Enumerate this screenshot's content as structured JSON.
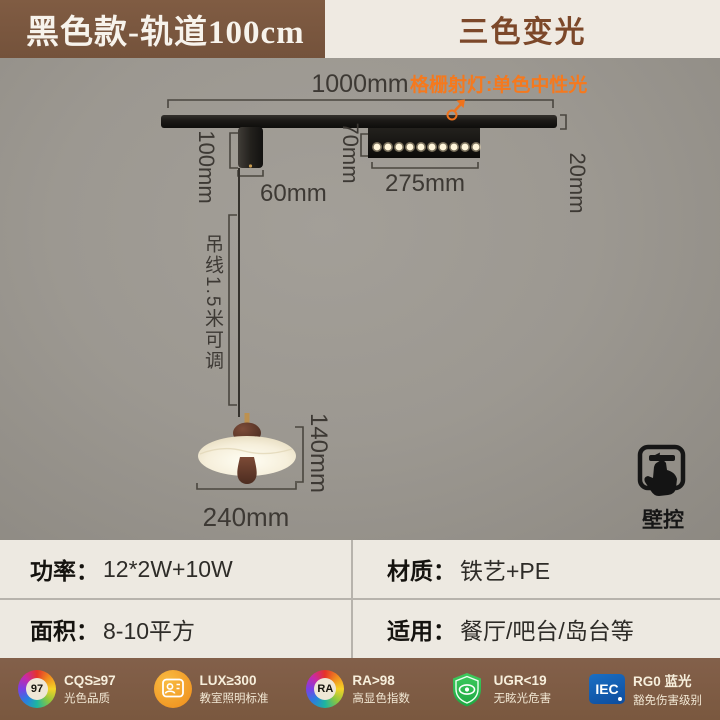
{
  "header": {
    "left_title": "黑色款-轨道100cm",
    "right_title": "三色变光"
  },
  "diagram": {
    "track_length": "1000mm",
    "track_height": "20mm",
    "spotlight_note": "格栅射灯:单色中性光",
    "mount_height": "100mm",
    "mount_width": "60mm",
    "spotlight_height": "70mm",
    "spotlight_length": "275mm",
    "wire_note": "吊线1.5米可调",
    "lamp_height": "140mm",
    "lamp_width": "240mm",
    "wall_control": "壁控"
  },
  "specs": {
    "cells": [
      {
        "label": "功率：",
        "value": "12*2W+10W"
      },
      {
        "label": "材质：",
        "value": "铁艺+PE"
      },
      {
        "label": "面积：",
        "value": "8-10平方"
      },
      {
        "label": "适用：",
        "value": "餐厅/吧台/岛台等"
      }
    ]
  },
  "certifications": [
    {
      "icon": "cqs-color-quality-icon",
      "badge": "97",
      "line1": "CQS≥97",
      "line2": "光色品质"
    },
    {
      "icon": "classroom-lighting-icon",
      "line1": "LUX≥300",
      "line2": "教室照明标准"
    },
    {
      "icon": "ra-color-wheel-icon",
      "badge": "RA",
      "line1": "RA>98",
      "line2": "高显色指数"
    },
    {
      "icon": "anti-glare-shield-icon",
      "line1": "UGR<19",
      "line2": "无眩光危害"
    },
    {
      "icon": "iec-logo-icon",
      "badge": "IEC",
      "line1": "RG0 蓝光",
      "line2": "豁免伤害级别"
    }
  ],
  "colors": {
    "banner_brown": "#7a5740",
    "banner_cream": "#efeae2",
    "banner_accent_text": "#7c482a",
    "background_gray": "#9c9891",
    "accent_orange": "#f5791e",
    "panel_cream": "#ede9e1",
    "footer_brown": "#7d5b43",
    "shield_green": "#2fbf52",
    "iec_blue": "#1563b5",
    "led_warm_white": "#fff6da"
  }
}
